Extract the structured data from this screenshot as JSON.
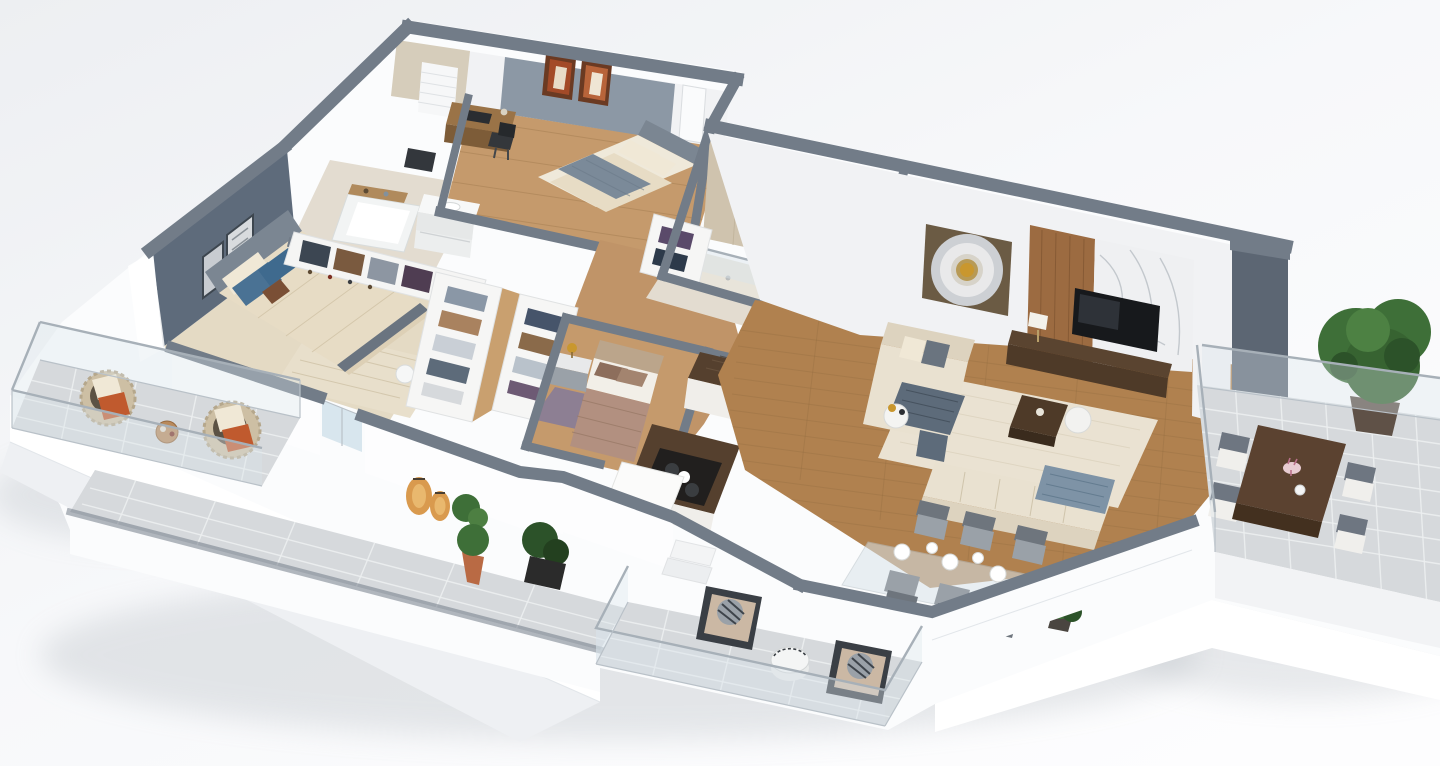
{
  "meta": {
    "title": "3D isometric apartment floor plan render",
    "render_type": "isometric-floor-plan",
    "canvas": {
      "width": 1440,
      "height": 766
    }
  },
  "palette": {
    "bg_top": "#edeff2",
    "bg_bottom": "#fdfdfe",
    "wall_cap": "#727c88",
    "wall_cap_dark": "#5c6673",
    "wall_face": "#f1f2f4",
    "accent_wall": "#5e6b7b",
    "wood_living": "#b0814f",
    "wood_bedroom": "#c59a6c",
    "bath_floor": "#e3dcd0",
    "bath_tile_wall": "#cfc3ae",
    "balcony_tile": "#d6d9dc",
    "glass": "#d9e4ea",
    "sofa_cream": "#e9e1d0",
    "rug_cream": "#eae2d2",
    "rug_master": "#e4dac4",
    "rug_purple": "#8d7f93",
    "table_walnut": "#4e3a28",
    "wood_panel": "#9c6b41",
    "marble": "#eff0f2",
    "tv_black": "#17191c",
    "counter_granite": "#55402e",
    "cabinet_white": "#f0eeea",
    "pillow_blue": "#4a7294",
    "pillow_rust": "#c05a2e",
    "pillow_cream": "#f0e8d6",
    "throw_gray": "#5d6b7a",
    "throw_blue": "#7e93a6",
    "plant_green": "#3e6f38",
    "plant_dark": "#2c5229",
    "lantern_amber": "#d99a4e",
    "bed_beige": "#e7dcc5",
    "blanket_gray": "#7b8a99",
    "bedding_mauve": "#b29080",
    "headboard_gray": "#7b8692",
    "art_rust": "#a34a28",
    "gold": "#c9972e",
    "slab_white": "#fbfcfd",
    "shadow": "#a9b0b7"
  },
  "scene": {
    "rooms": [
      {
        "id": "guest-bedroom",
        "furniture": [
          "double-bed",
          "gray-blanket",
          "headboard",
          "desk",
          "desk-chair",
          "laptop",
          "wall-art-pair",
          "window-blind",
          "slate-accent-wall",
          "door"
        ]
      },
      {
        "id": "bathroom-top",
        "furniture": [
          "bathtub",
          "wood-tray",
          "vanity-sink",
          "window"
        ]
      },
      {
        "id": "master-bedroom",
        "furniture": [
          "double-bed",
          "blue-pillows",
          "rust-accent-pillow",
          "patterned-rug",
          "accent-wall",
          "wall-art-pair",
          "round-side-table",
          "window-to-balcony"
        ]
      },
      {
        "id": "master-closet",
        "furniture": [
          "open-wardrobe-row",
          "folded-clothes",
          "shoe-shelf"
        ]
      },
      {
        "id": "walk-in-closet",
        "furniture": [
          "shelf-row-left",
          "shelf-row-right",
          "folded-clothes"
        ]
      },
      {
        "id": "shower-bathroom",
        "furniture": [
          "walk-in-shower",
          "glass-screen",
          "toilet",
          "wardrobe-left",
          "wardrobe-right"
        ]
      },
      {
        "id": "small-bedroom",
        "furniture": [
          "bed",
          "nightstand",
          "gold-table-lamp",
          "purple-rug"
        ]
      },
      {
        "id": "kitchen",
        "furniture": [
          "l-shaped-granite-counter",
          "sink",
          "cooktop",
          "yellow-bowl",
          "white-appliance"
        ]
      },
      {
        "id": "living-room",
        "furniture": [
          "sectional-sofa",
          "gray-throw",
          "blue-throw",
          "cream-rug",
          "coffee-table",
          "nesting-table",
          "side-table-gold-lamp",
          "circular-wall-art",
          "tv",
          "wood-panel",
          "marble-panel",
          "media-console",
          "console-lamp"
        ]
      },
      {
        "id": "dining-area",
        "furniture": [
          "glass-dining-table",
          "six-gray-chairs",
          "white-plates",
          "corner-plant"
        ]
      },
      {
        "id": "entry",
        "furniture": [
          "steps",
          "potted-plants"
        ]
      }
    ],
    "balconies": [
      {
        "id": "left-balcony",
        "furniture": [
          "wicker-chair-x2",
          "cream-pillows",
          "rust-pillows",
          "round-wood-table",
          "glass-railing",
          "tile-floor"
        ]
      },
      {
        "id": "front-terrace",
        "furniture": [
          "amber-lantern-x2",
          "terracotta-potted-plant",
          "dark-leaf-plant",
          "tile-walkway",
          "parapet"
        ]
      },
      {
        "id": "bottom-balcony",
        "furniture": [
          "lounge-chair-x2",
          "patterned-pillows",
          "white-drum-table",
          "glass-railing",
          "tile-floor"
        ]
      },
      {
        "id": "right-balcony",
        "furniture": [
          "outdoor-dining-table",
          "flower-vase",
          "chair-x4",
          "large-potted-tree",
          "glass-railing",
          "tile-floor"
        ]
      }
    ]
  }
}
